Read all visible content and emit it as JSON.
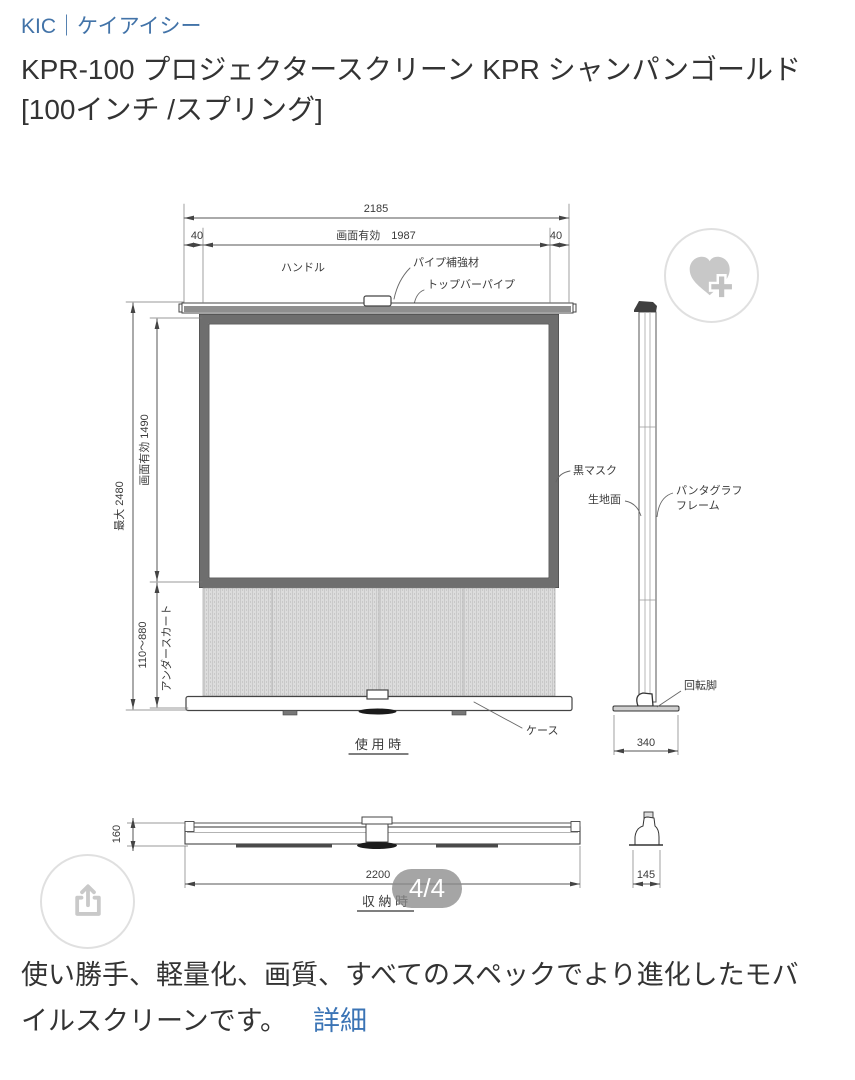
{
  "brand": {
    "label": "KIC｜ケイアイシー"
  },
  "title": {
    "line1": "KPR-100 プロジェクタースクリーン KPR シャンパンゴールド",
    "line2": "[100インチ /スプリング]"
  },
  "diagram": {
    "front_view": {
      "dim_total_width": "2185",
      "dim_margin_left": "40",
      "dim_effective_width": "画面有効　1987",
      "dim_margin_right": "40",
      "label_handle": "ハンドル",
      "label_pipe_reinforcement": "パイプ補強材",
      "label_top_bar_pipe": "トップバーパイプ",
      "dim_max_height": "最大 2480",
      "dim_effective_height": "画面有効 1490",
      "dim_underskirt_height": "110〜880",
      "label_underskirt": "アンダースカート",
      "label_black_mask": "黒マスク",
      "label_case": "ケース",
      "caption": "使 用 時"
    },
    "side_view": {
      "label_fabric_surface": "生地面",
      "label_pantograph_line1": "パンタグラフ",
      "label_pantograph_line2": "フレーム",
      "label_rotating_foot": "回転脚",
      "dim_base_depth": "340"
    },
    "stored_view": {
      "dim_height": "160",
      "dim_width": "2200",
      "dim_depth": "145",
      "caption": "収 納 時"
    }
  },
  "overlays": {
    "page_indicator": "4/4"
  },
  "description": {
    "line1": "使い勝手、軽量化、画質、すべてのスペックでより進化したモバ",
    "line2": "イルスクリーンです。",
    "detail_link": "詳細"
  },
  "colors": {
    "link_blue": "#4273a8",
    "detail_link_blue": "#3b74b5",
    "text_dark": "#333333",
    "badge_bg": "#8c8c8c",
    "icon_gray": "#c8c8c8",
    "circle_border": "#e0e0e0",
    "frame_gray": "#6e6e6e"
  }
}
